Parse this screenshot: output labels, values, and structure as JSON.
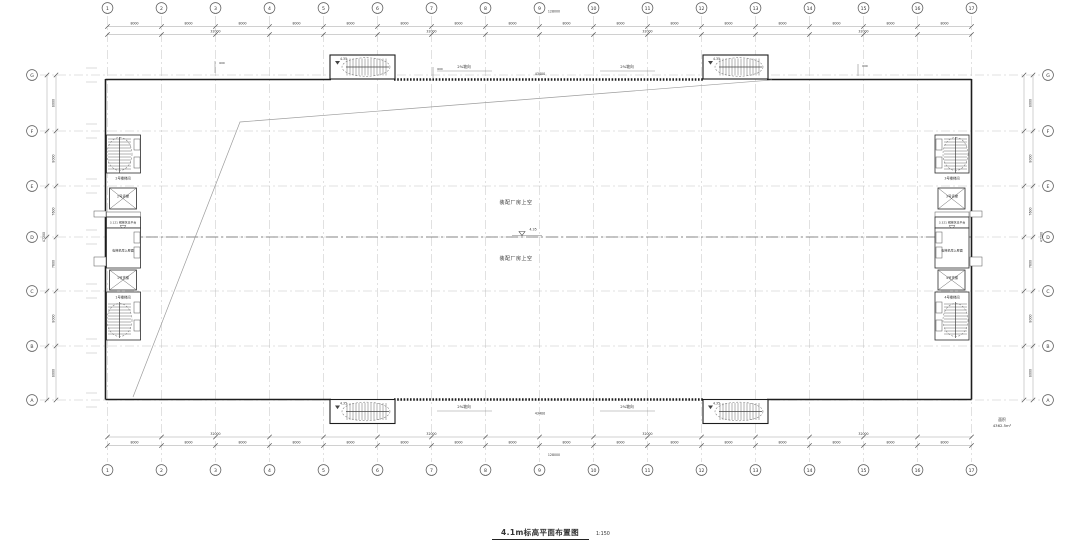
{
  "sheet": {
    "title": "4.1m标高平面布置图",
    "scale": "1:150",
    "area_label": "面积",
    "area_value": "4362.5m²"
  },
  "grid": {
    "columns": [
      "1",
      "2",
      "3",
      "4",
      "5",
      "6",
      "7",
      "8",
      "9",
      "10",
      "11",
      "12",
      "13",
      "14",
      "15",
      "16",
      "17"
    ],
    "rows": [
      "G",
      "F",
      "E",
      "D",
      "C",
      "B",
      "A"
    ]
  },
  "dimensions": {
    "top": {
      "bays": [
        "8000",
        "8000",
        "8000",
        "8000",
        "8000",
        "8000",
        "8000",
        "8000",
        "8000",
        "8000",
        "8000",
        "8000",
        "8000",
        "8000",
        "8000",
        "8000"
      ],
      "spans": [
        "32000",
        "32000",
        "32000",
        "32000"
      ],
      "total": "128000"
    },
    "bottom": {
      "bays": [
        "8000",
        "8000",
        "8000",
        "8000",
        "8000",
        "8000",
        "8000",
        "8000",
        "8000",
        "8000",
        "8000",
        "8000",
        "8000",
        "8000",
        "8000",
        "8000"
      ],
      "spans": [
        "32000",
        "32000",
        "32000",
        "32000"
      ],
      "total": "128000"
    },
    "left": {
      "bays": [
        "8000",
        "8000",
        "7600",
        "7600",
        "8000",
        "8000"
      ],
      "total": "47200"
    },
    "right": {
      "bays": [
        "8000",
        "8000",
        "7600",
        "7600",
        "8000",
        "8000"
      ],
      "total": "47200"
    },
    "edge_offset": "600",
    "center_width": "43400"
  },
  "cores": {
    "left": {
      "stair_upper": "2号楼梯间",
      "lift_upper": "2号货梯",
      "platform": "3.121 钢梯休息平台",
      "machine_room": "电梯机房上屋面",
      "lift_lower": "1号货梯",
      "stair_lower": "1号楼梯间"
    },
    "right": {
      "stair_upper": "3号楼梯间",
      "lift_upper": "3号货梯",
      "platform": "3.321 钢梯休息平台",
      "machine_room": "电梯机房上屋面",
      "lift_lower": "4号货梯",
      "stair_lower": "4号楼梯间"
    }
  },
  "annotations": {
    "hall_upper": "装配厂房上空",
    "hall_lower": "装配厂房上空",
    "level": "4.35",
    "tower_level": "4.35",
    "slope_left": "2%坡向",
    "slope_right": "2%坡向",
    "slope_left_bottom": "2%坡向",
    "slope_right_bottom": "2%坡向"
  }
}
